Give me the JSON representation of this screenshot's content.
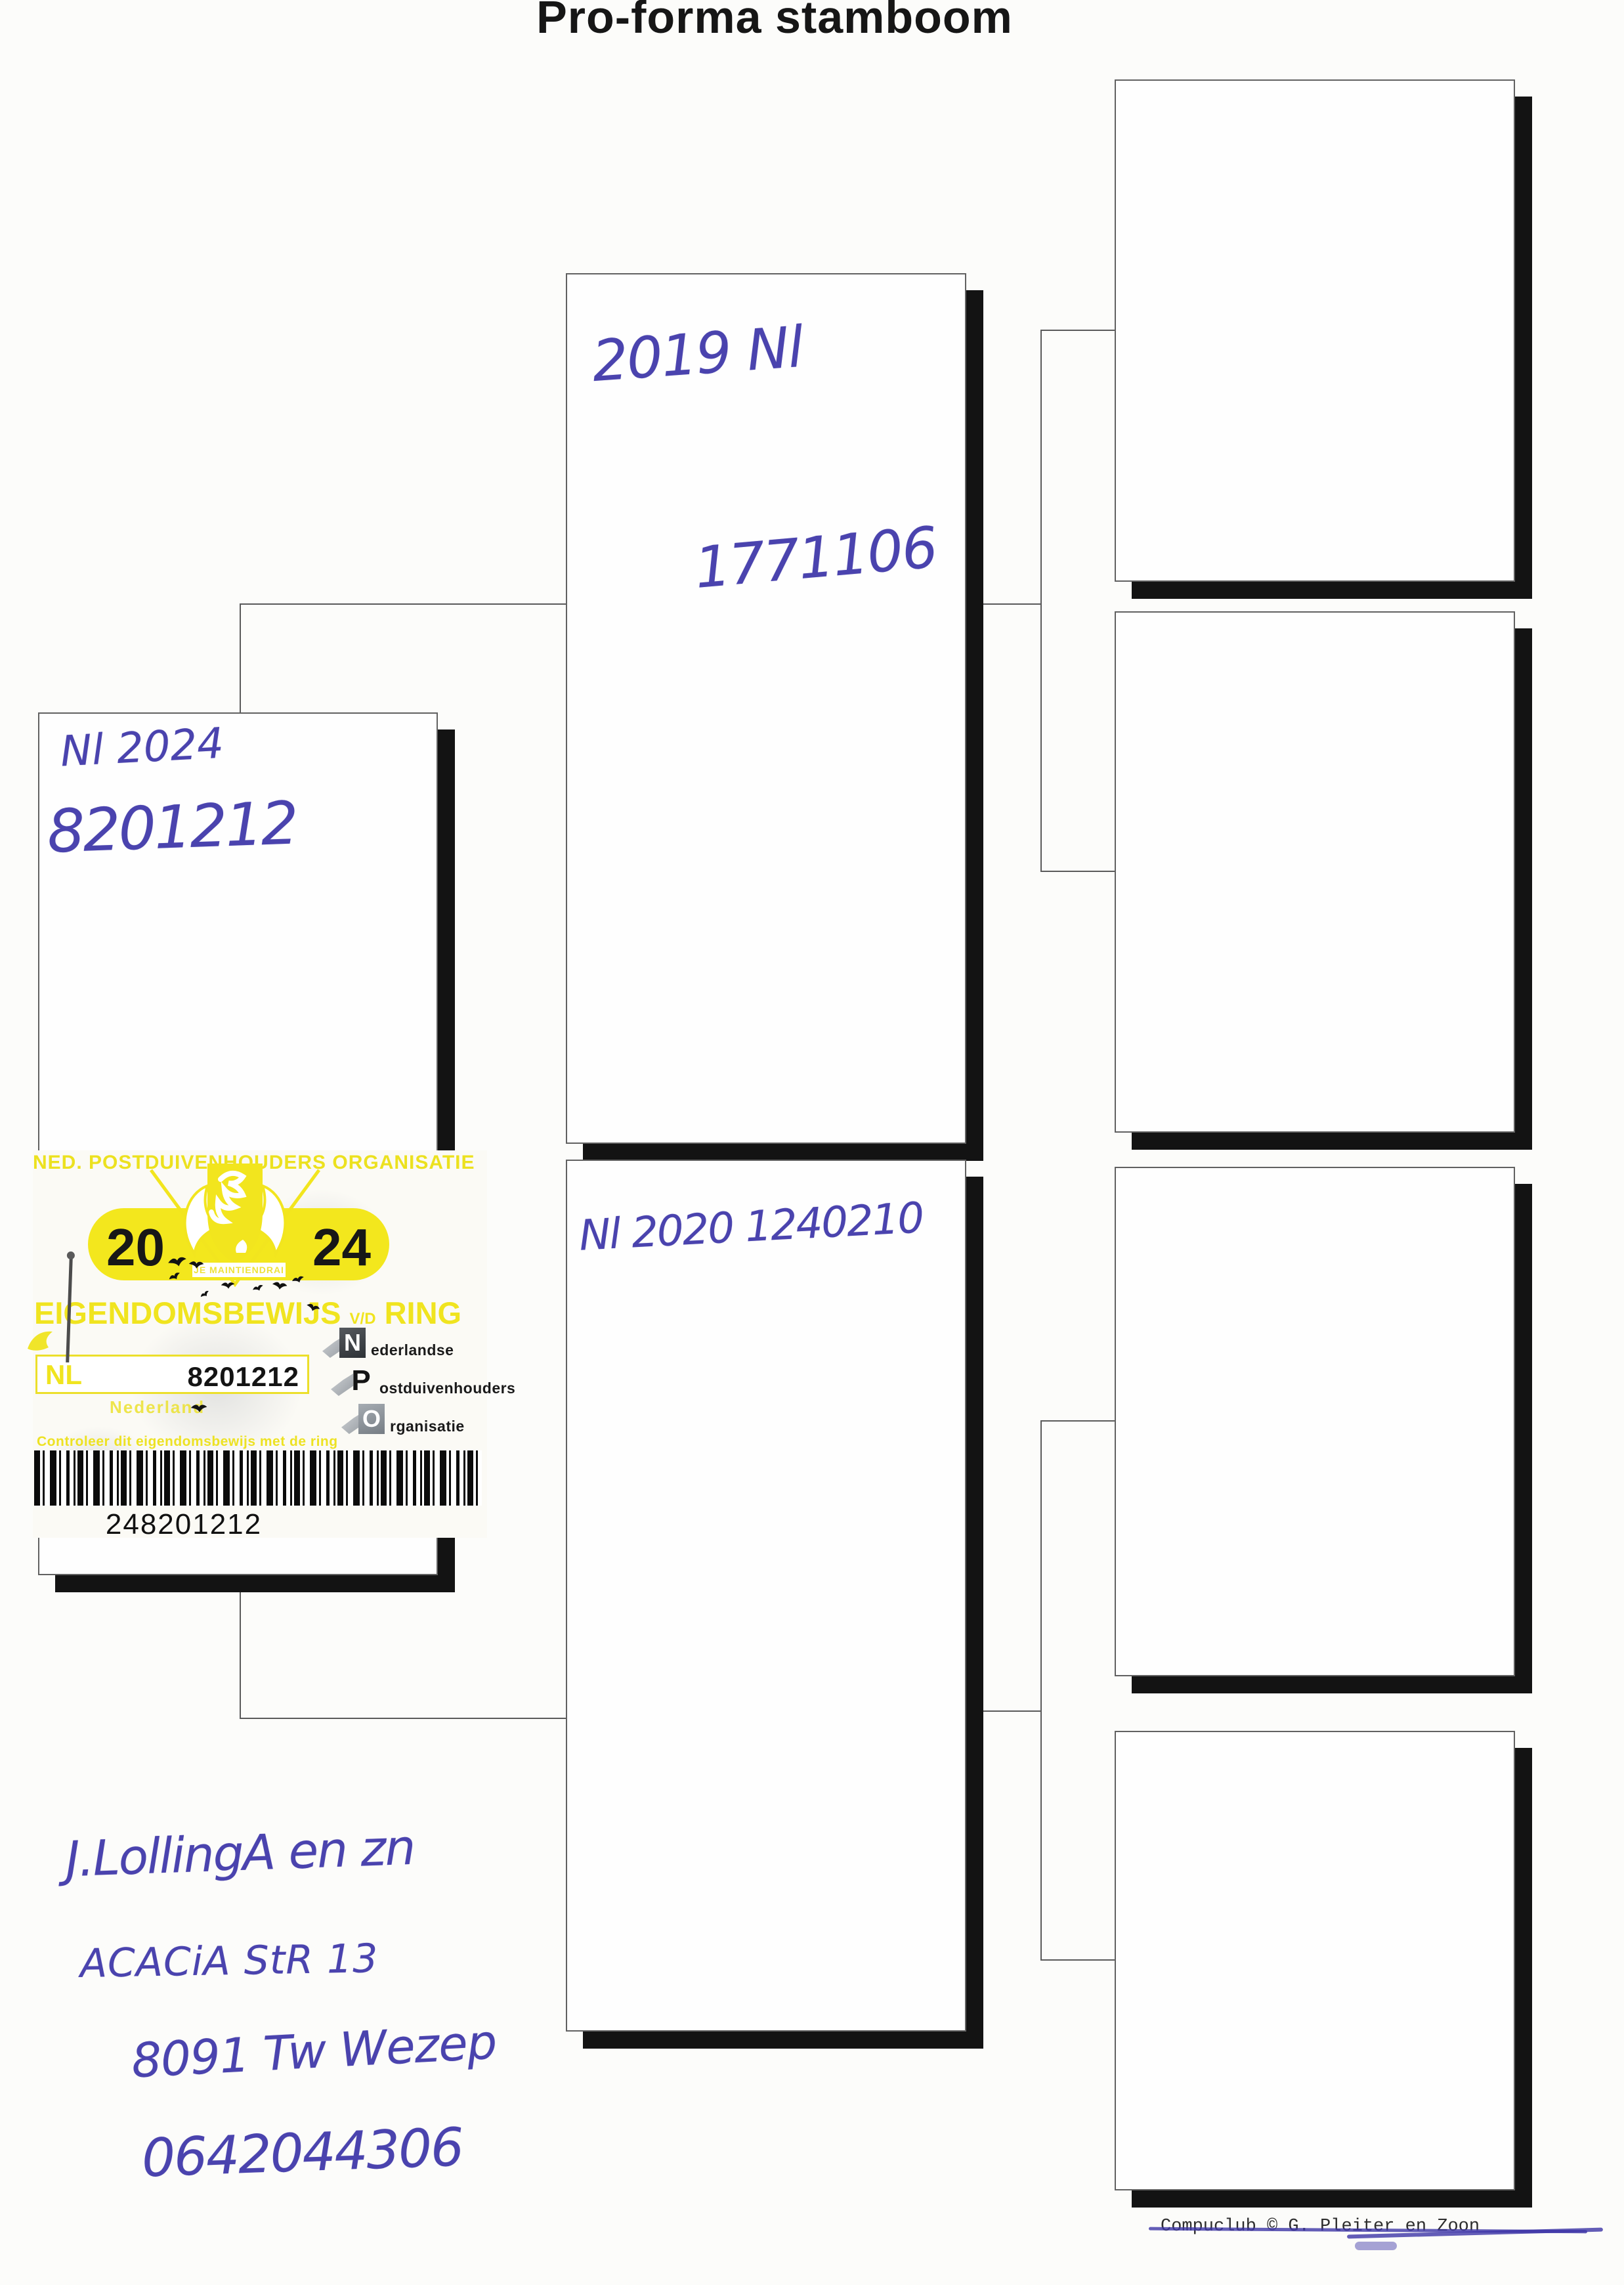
{
  "title": "Pro-forma stamboom",
  "pedigree": {
    "subject": {
      "line1": "Nl 2024",
      "line2": "8201212"
    },
    "sire": {
      "line1": "2019 Nl",
      "line2": "1771106"
    },
    "dam": {
      "line1": "Nl 2020 1240210"
    }
  },
  "sticker": {
    "header": "NED. POSTDUIVENHOUDERS ORGANISATIE",
    "year_left": "20",
    "year_right": "24",
    "motto": "JE MAINTIENDRAI",
    "title_main": "EIGENDOMSBEWIJS",
    "title_small": "V/D",
    "title_end": "RING",
    "country_code": "NL",
    "ring_number": "8201212",
    "country_name": "Nederland",
    "org": [
      {
        "initial": "N",
        "rest": "ederlandse"
      },
      {
        "initial": "P",
        "rest": "ostduivenhouders"
      },
      {
        "initial": "O",
        "rest": "rganisatie"
      }
    ],
    "check_note": "Controleer dit eigendomsbewijs met de ring",
    "barcode_number": "248201212"
  },
  "owner": {
    "name": "J.LollingA en zn",
    "street": "ACACiA StR 13",
    "city": "8091 Tw Wezep",
    "phone": "0642044306"
  },
  "footer": {
    "credit": "Compuclub © G. Pleiter en Zoon"
  },
  "colors": {
    "ink_blue": "#4a43ae",
    "sticker_yellow": "#f3e71d",
    "shadow_black": "#131313"
  }
}
